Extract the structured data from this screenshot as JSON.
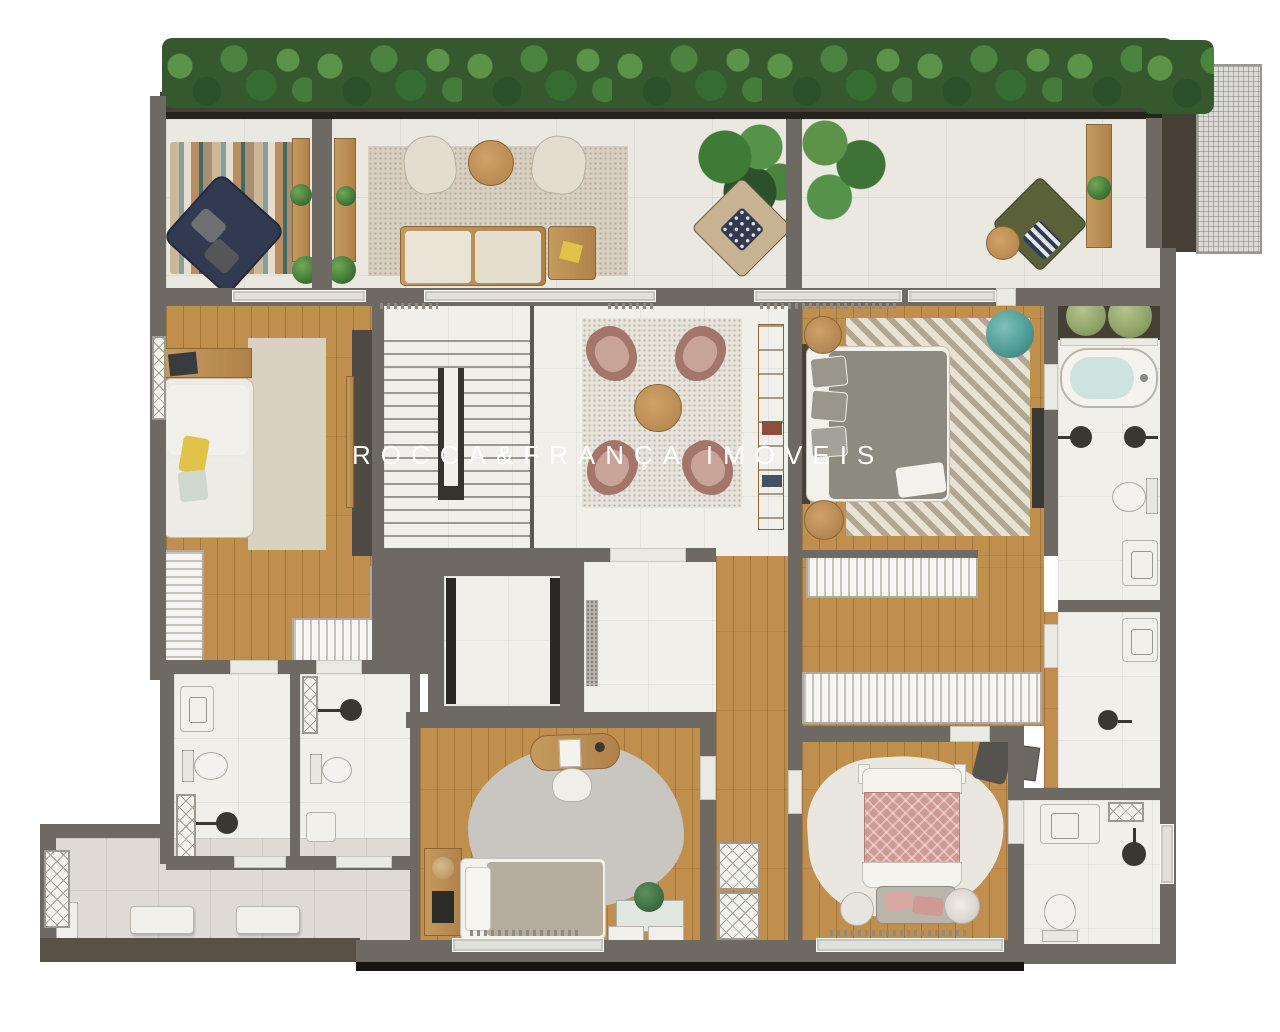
{
  "meta": {
    "type": "apartment-floor-plan-rendering",
    "width_px": 1280,
    "height_px": 1032
  },
  "watermark": {
    "text": "ROCCA&FRANÇA IMÓVEIS",
    "color": "#ffffff"
  },
  "palette": {
    "wall": "#6e6a63",
    "wall_dark": "#26231e",
    "wood": "#c08f4e",
    "marble": "#f0efea",
    "terrace": "#eae8e1",
    "tile": "#dfdbd4",
    "planter": "#453f35",
    "hedge_green": "#3e7337",
    "rug_beige": "#d8cfc0",
    "rug_speckle": "#e7e3da",
    "rug_grey": "#c9c5c0",
    "navy": "#323a52",
    "olive": "#5a6139",
    "teal": "#4f9d97",
    "mauve": "#a4756a",
    "cream": "#e6e0d2",
    "pink": "#cf9a94",
    "yellow": "#e2c34a",
    "green_accent": "#3f6f44",
    "tub_water": "#cfe3de",
    "bottom_strip_brown": "#5a5146"
  }
}
